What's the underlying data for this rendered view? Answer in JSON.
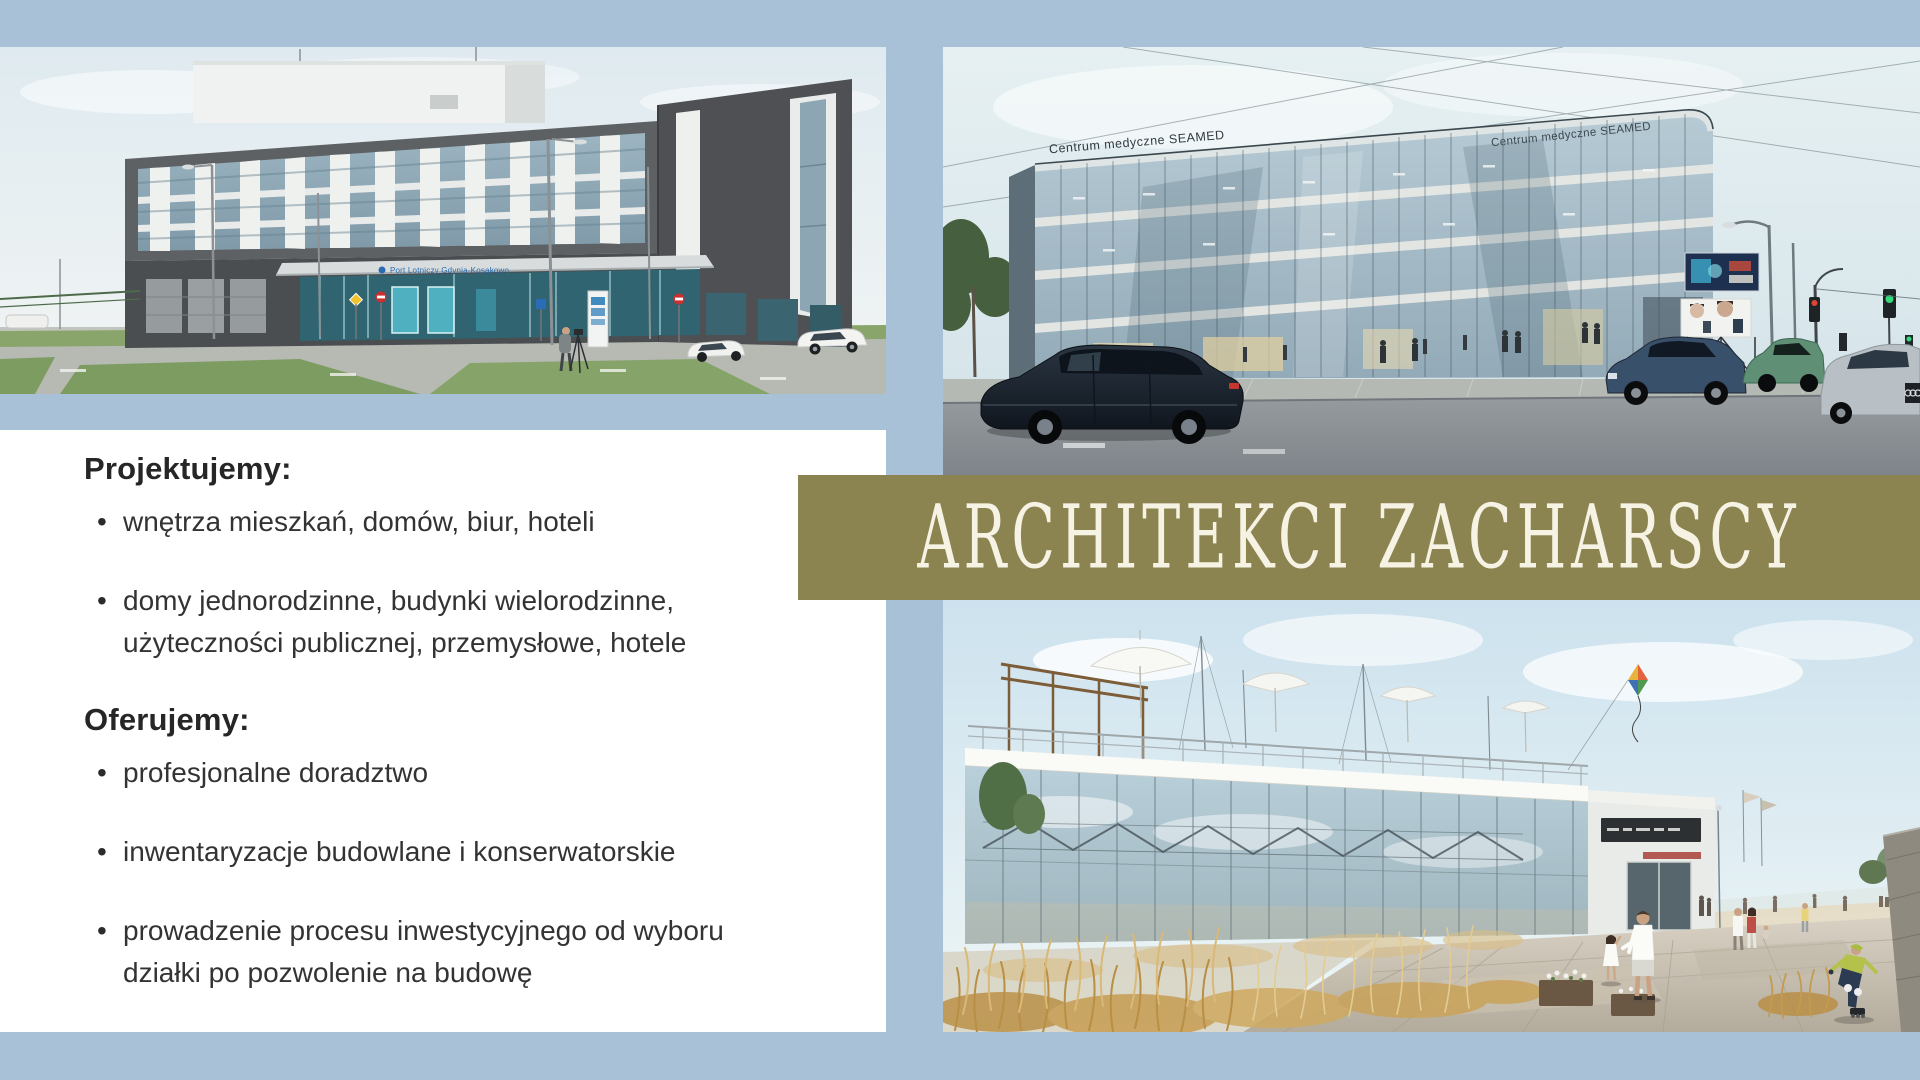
{
  "colors": {
    "page_background": "#a9c1d6",
    "banner_background": "#8b8451",
    "banner_text": "#f7f3e4",
    "panel_background": "#ffffff",
    "body_text": "#333333"
  },
  "banner": {
    "title": "ARCHITEKCI ZACHARSCY"
  },
  "services": {
    "design": {
      "heading": "Projektujemy:",
      "items": [
        "wnętrza mieszkań, domów, biur, hoteli",
        "domy jednorodzinne, budynki wielorodzinne, użyteczności publicznej, przemysłowe, hotele"
      ]
    },
    "offer": {
      "heading": "Oferujemy:",
      "items": [
        "profesjonalne doradztwo",
        "inwentaryzacje budowlane i konserwatorskie",
        "prowadzenie procesu inwestycyjnego od wyboru działki po pozwolenie na budowę"
      ]
    }
  },
  "photos": {
    "airport": {
      "canopy_sign": "Port Lotniczy Gdynia-Kosakowo"
    },
    "seamed": {
      "parapet_label": "Centrum medyczne SEAMED"
    }
  }
}
